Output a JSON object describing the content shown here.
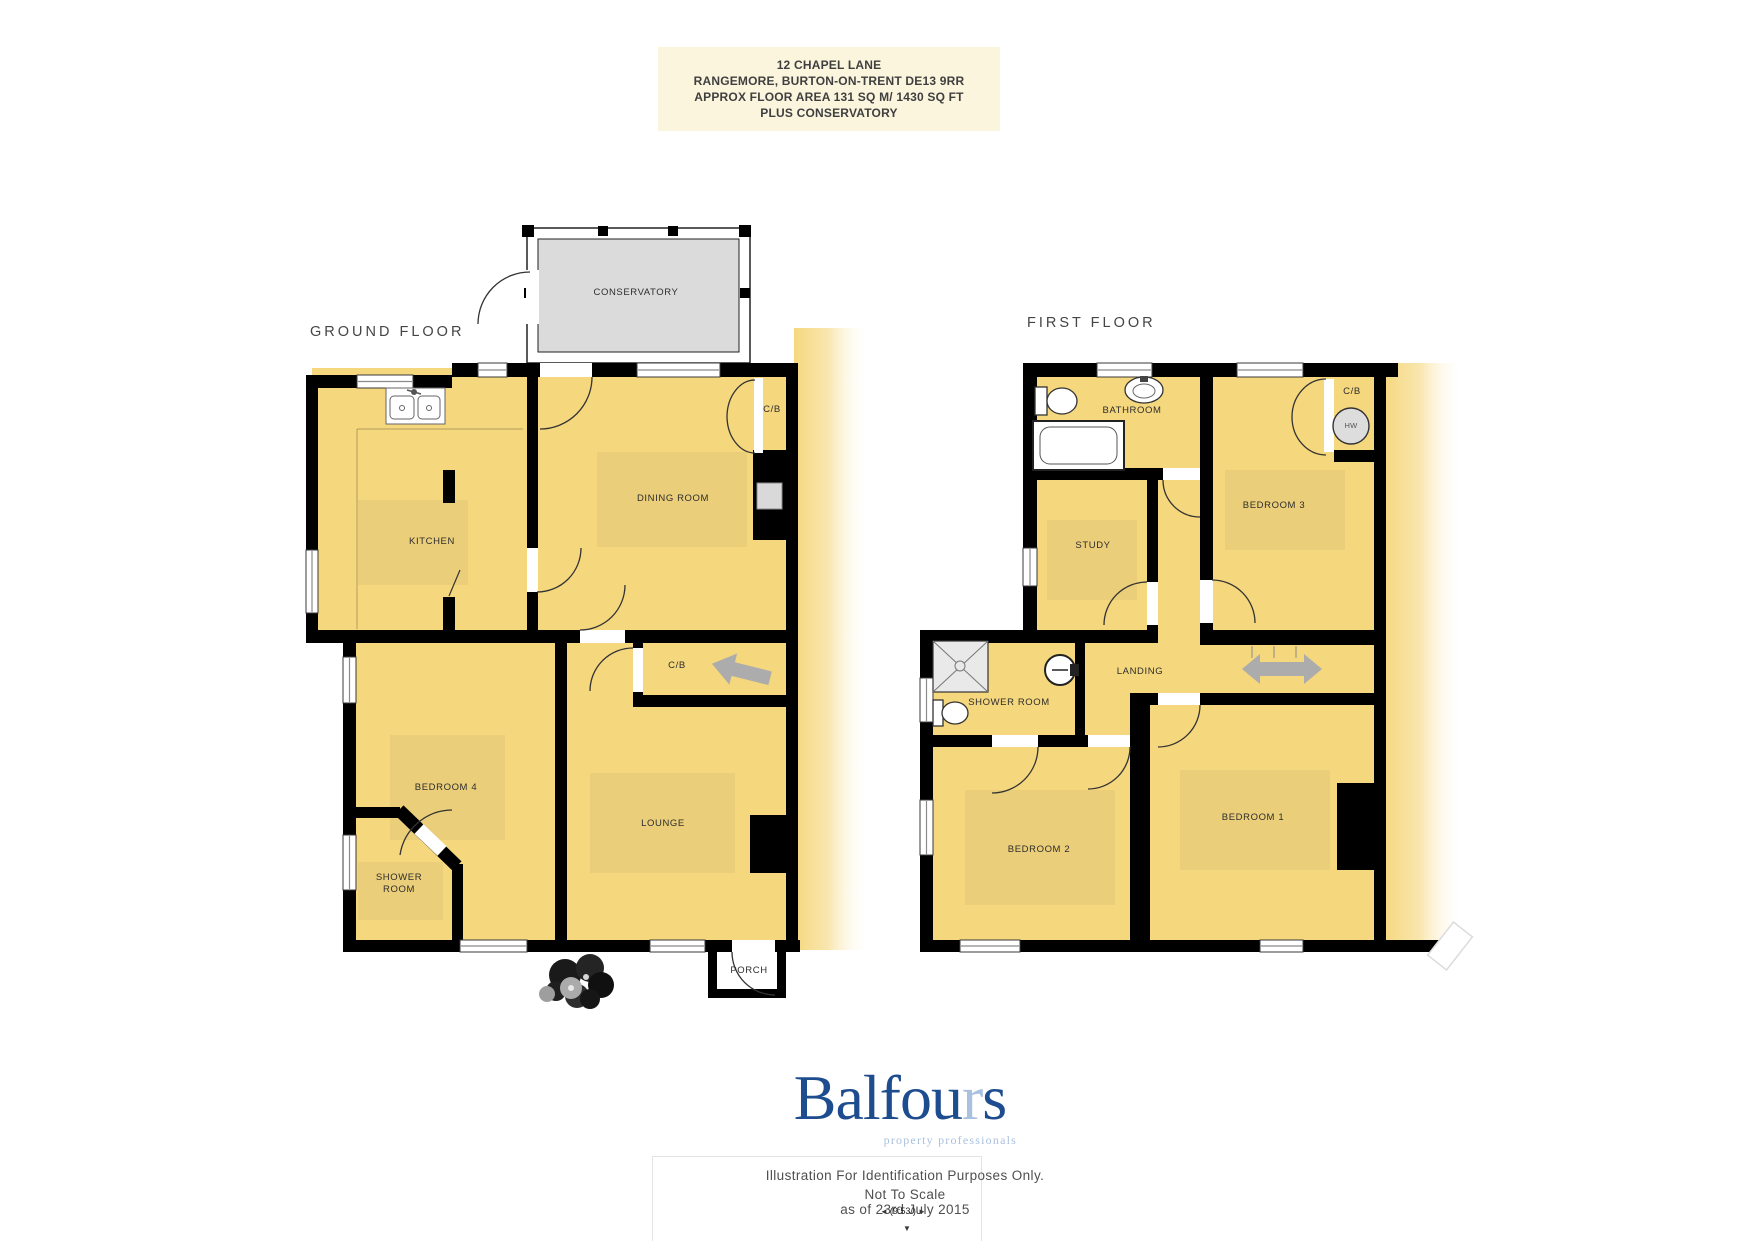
{
  "title_block": {
    "line1": "12 CHAPEL LANE",
    "line2": "RANGEMORE, BURTON-ON-TRENT DE13 9RR",
    "line3": "APPROX FLOOR AREA 131 SQ M/ 1430 SQ FT",
    "line4": "PLUS CONSERVATORY"
  },
  "ground_floor": {
    "title": "GROUND FLOOR",
    "conservatory": "CONSERVATORY",
    "kitchen": "KITCHEN",
    "dining_room": "DINING ROOM",
    "cupboard_dining": "C/B",
    "cupboard_hall": "C/B",
    "bedroom4": "BEDROOM 4",
    "shower_line1": "SHOWER",
    "shower_line2": "ROOM",
    "lounge": "LOUNGE",
    "porch": "PORCH"
  },
  "first_floor": {
    "title": "FIRST FLOOR",
    "bathroom": "BATHROOM",
    "study": "STUDY",
    "bedroom3": "BEDROOM 3",
    "cupboard": "C/B",
    "hot_water": "HW",
    "landing": "LANDING",
    "shower_room": "SHOWER ROOM",
    "bedroom2": "BEDROOM 2",
    "bedroom1": "BEDROOM 1"
  },
  "footer": {
    "brand_part1": "Balfou",
    "brand_part2": "r",
    "brand_part3": "s",
    "tagline": "property professionals",
    "disclaimer_line1": "Illustration For Identification Purposes Only.",
    "disclaimer_line2": "Not To Scale",
    "disclaimer_line3": "as of 23rd July 2015"
  },
  "overlay": {
    "prev": "◄",
    "label": "(9:53/)",
    "next": "►",
    "down": "▼"
  },
  "colors": {
    "room_fill": "#F5D77E",
    "conservatory_fill": "#DBDBDB",
    "wall": "#000000",
    "brand_blue": "#1D4C8F",
    "brand_light_blue": "#A9C0DE",
    "title_bg": "#FBF5DE",
    "arrow_gray": "#ACACAC"
  }
}
